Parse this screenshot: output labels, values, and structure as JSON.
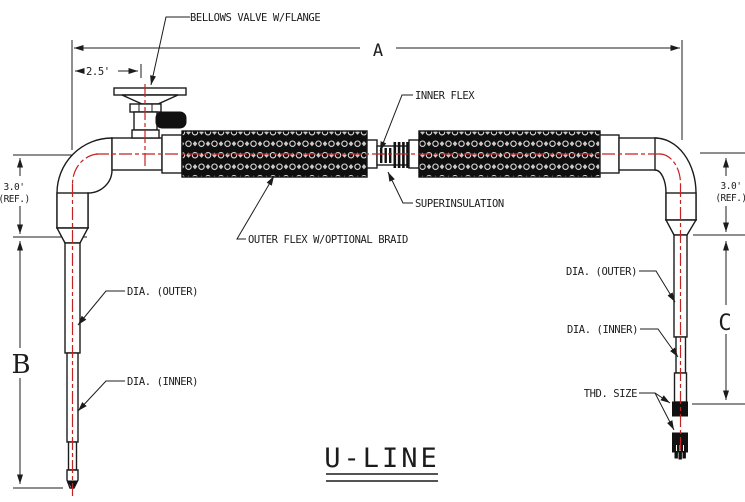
{
  "drawing": {
    "title": "U-LINE",
    "callouts": {
      "bellows_valve": "BELLOWS VALVE W/FLANGE",
      "inner_flex": "INNER FLEX",
      "superinsulation": "SUPERINSULATION",
      "outer_flex": "OUTER FLEX W/OPTIONAL BRAID",
      "dia_outer_left": "DIA. (OUTER)",
      "dia_inner_left": "DIA. (INNER)",
      "dia_outer_right": "DIA. (OUTER)",
      "dia_inner_right": "DIA. (INNER)",
      "thd_size": "THD. SIZE"
    },
    "dimensions": {
      "overall_length": "A",
      "left_leg": "B",
      "right_leg": "C",
      "valve_offset": "2.5'",
      "ref_left_value": "3.0'",
      "ref_left_suffix": "(REF.)",
      "ref_right_value": "3.0'",
      "ref_right_suffix": "(REF.)"
    },
    "colors": {
      "line": "#1c1c1c",
      "centerline": "#c52222",
      "background": "#ffffff"
    }
  }
}
